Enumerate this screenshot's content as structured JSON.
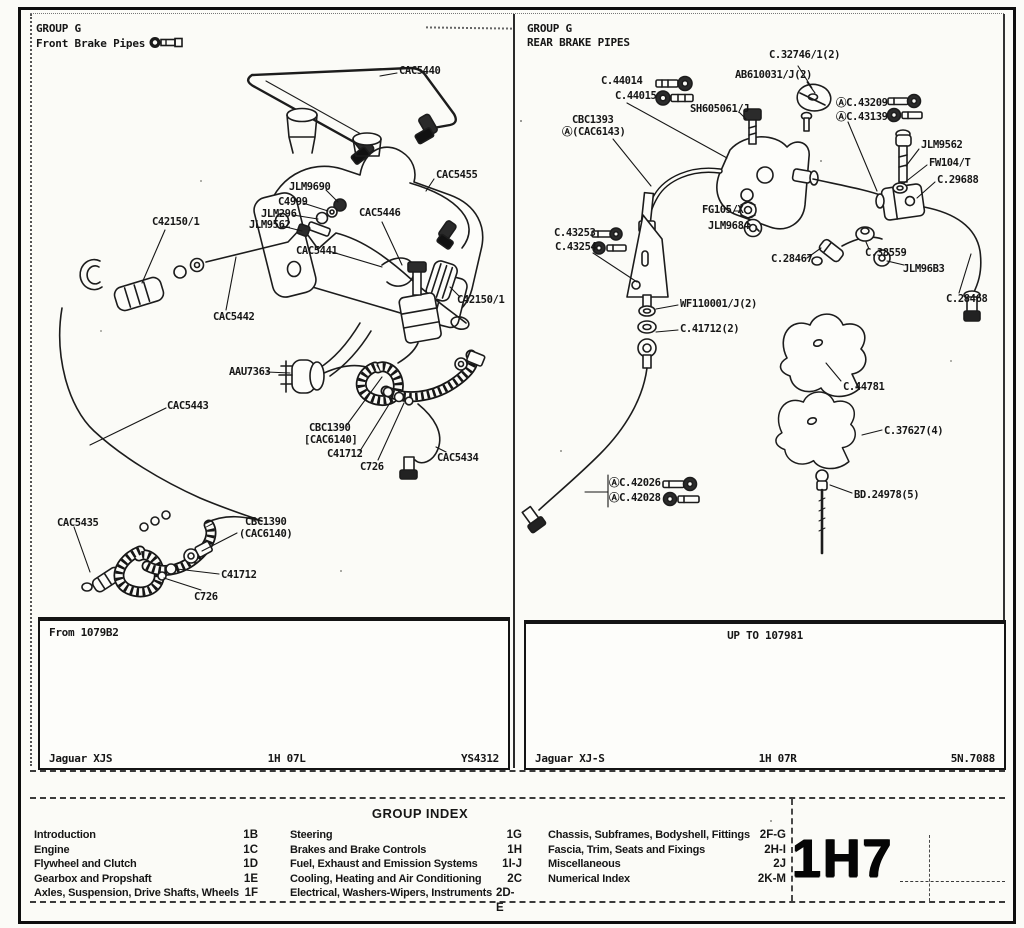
{
  "front_page": {
    "header": {
      "group": "GROUP G",
      "title": "Front Brake Pipes"
    },
    "labels": {
      "cac5440": "CAC5440",
      "cac5455": "CAC5455",
      "jlm9690": "JLM9690",
      "c4999": "C4999",
      "jlm296": "JLM296",
      "jlm9562": "JLM9562",
      "cac5446": "CAC5446",
      "c42150_left": "C42150/1",
      "cac5441": "CAC5441",
      "cac5442": "CAC5442",
      "c42150_right": "C42150/1",
      "aau7363": "AAU7363",
      "cac5443": "CAC5443",
      "cbc1390_a": "CBC1390",
      "cac6140_a": "[CAC6140]",
      "c41712_a": "C41712",
      "c726_a": "C726",
      "cac5434": "CAC5434",
      "cac5435": "CAC5435",
      "cbc1390_b": "CBC1390",
      "cac6140_b": "(CAC6140)",
      "c41712_b": "C41712",
      "c726_b": "C726"
    },
    "footer": {
      "range": "From 1079B2",
      "model": "Jaguar XJS",
      "sheet": "1H 07L",
      "ref": "YS4312"
    }
  },
  "rear_page": {
    "header": {
      "group": "GROUP G",
      "title": "REAR BRAKE PIPES"
    },
    "labels": {
      "c32746": "C.32746/1(2)",
      "ab610031": "AB610031/J(2)",
      "c44014": "C.44014",
      "c44015": "C.44015",
      "sh605061": "SH605061/J",
      "cbc1393": "CBC1393",
      "cac6143": "Ⓐ(CAC6143)",
      "c43209": "ⒶC.43209",
      "c43139": "ⒶC.43139",
      "jlm9562": "JLM9562",
      "fw104": "FW104/T",
      "c29688": "C.29688",
      "fg105": "FG105/X",
      "jlm9684": "JLM9684",
      "c43253": "C.43253",
      "c43254": "C.43254",
      "c28467": "C.28467",
      "c38559": "C.38559",
      "jlm96b3": "JLM96B3",
      "c28468": "C.28468",
      "wf110001": "WF110001/J(2)",
      "c41712": "C.41712(2)",
      "c44781": "C.44781",
      "c37627": "C.37627(4)",
      "c42026": "ⒶC.42026",
      "c42028": "ⒶC.42028",
      "bd24978": "BD.24978(5)"
    },
    "footer": {
      "range": "UP TO 107981",
      "model": "Jaguar XJ-S",
      "sheet": "1H 07R",
      "ref": "5N.7088"
    }
  },
  "group_index": {
    "title": "GROUP INDEX",
    "columns": [
      [
        {
          "label": "Introduction",
          "code": "1B"
        },
        {
          "label": "Engine",
          "code": "1C"
        },
        {
          "label": "Flywheel and Clutch",
          "code": "1D"
        },
        {
          "label": "Gearbox and Propshaft",
          "code": "1E"
        },
        {
          "label": "Axles, Suspension, Drive Shafts, Wheels",
          "code": "1F"
        }
      ],
      [
        {
          "label": "Steering",
          "code": "1G"
        },
        {
          "label": "Brakes and Brake Controls",
          "code": "1H"
        },
        {
          "label": "Fuel, Exhaust and Emission Systems",
          "code": "1I-J"
        },
        {
          "label": "Cooling, Heating and Air Conditioning",
          "code": "2C"
        },
        {
          "label": "Electrical, Washers-Wipers, Instruments",
          "code": "2D-E"
        }
      ],
      [
        {
          "label": "Chassis, Subframes, Bodyshell, Fittings",
          "code": "2F-G"
        },
        {
          "label": "Fascia, Trim, Seats and Fixings",
          "code": "2H-I"
        },
        {
          "label": "Miscellaneous",
          "code": "2J"
        },
        {
          "label": "Numerical Index",
          "code": "2K-M"
        }
      ]
    ]
  },
  "page_code": "1H7",
  "ink_color": "#161616"
}
